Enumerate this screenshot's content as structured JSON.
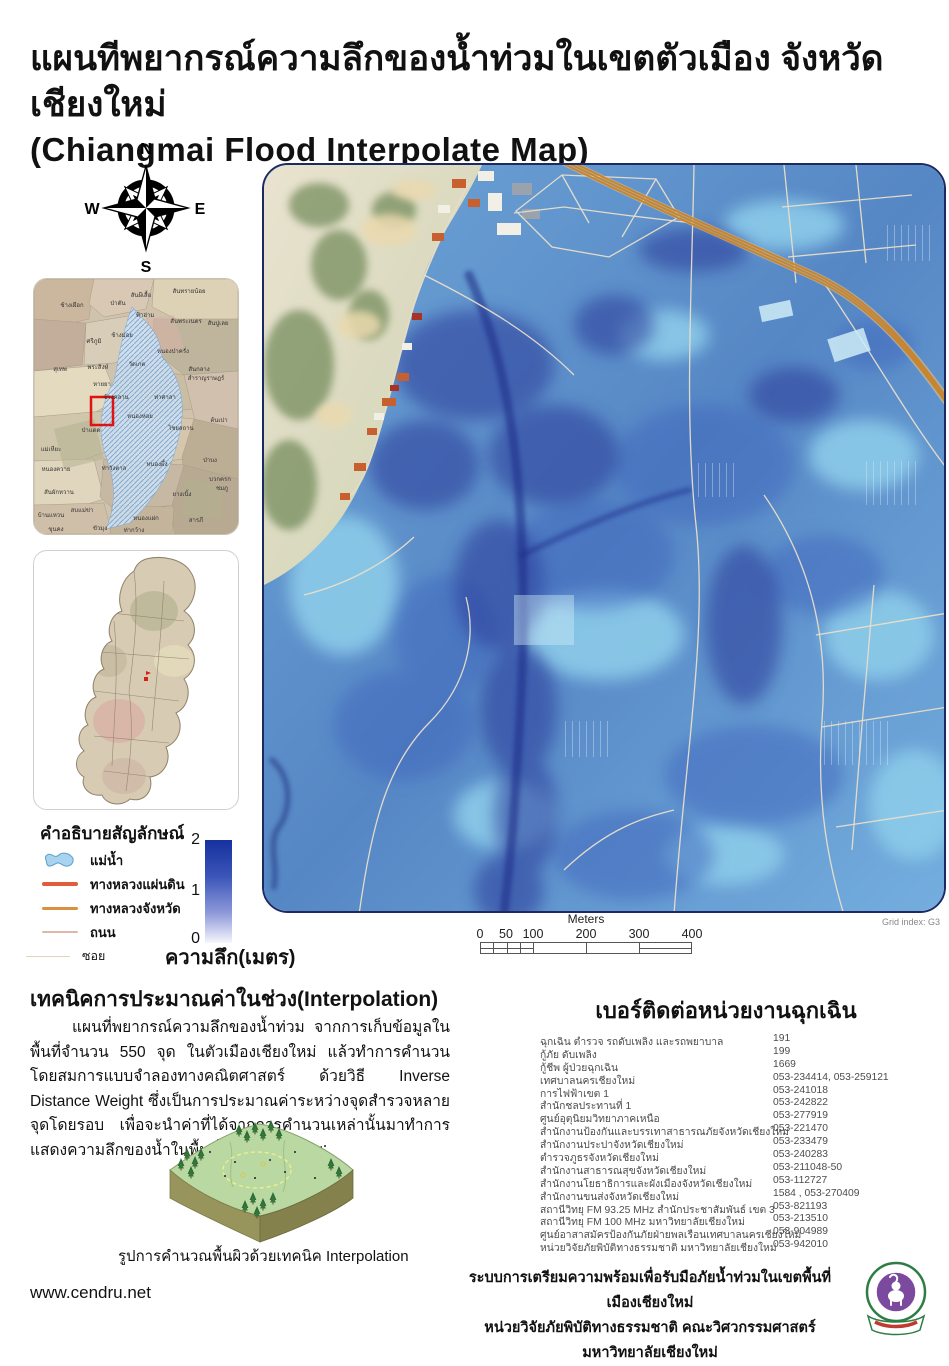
{
  "title": {
    "line1": "แผนทีพยากรณ์ความลึกของน้ำท่วมในเขตตัวเมือง จังหวัดเชียงใหม่",
    "line2": "(Chiangmai Flood Interpolate Map)"
  },
  "compass": {
    "n": "N",
    "e": "E",
    "s": "S",
    "w": "W"
  },
  "locator_map": {
    "marker_color": "#e01212",
    "labels": [
      "สันผีเสื้อ",
      "สันทรายน้อย",
      "ช้างเผือก",
      "ป่าตัน",
      "ฟ้าฮ่าม",
      "สันพระเนตร",
      "สันปูเลย",
      "ช้างม่อย",
      "ศรีภูมิ",
      "หนองป่าครั่ง",
      "สุเทพ",
      "พระสิงห์",
      "วัดเกต",
      "สันกลาง",
      "สำราญราษฎร์",
      "หายยา",
      "ช้างคลาน",
      "ท่าศาลา",
      "หนองหอย",
      "ไชยสถาน",
      "ต้นเปา",
      "ป่าแดด",
      "แม่เหียะ",
      "หนองควาย",
      "ท่าวังตาล",
      "หนองผึ้ง",
      "ป่าบง",
      "ยางเนิ้ง",
      "สันผักหวาน",
      "สบแม่ข่า",
      "บ้านแหวน",
      "หนองแฝก",
      "สารภี",
      "ชมภู",
      "บวกครก",
      "ขุนคง",
      "ขัวมุง",
      "ท่ากว้าง"
    ]
  },
  "legend": {
    "title": "คำอธิบายสัญลักษณ์",
    "items": [
      {
        "label": "แม่น้ำ",
        "icon": "river-polygon"
      },
      {
        "label": "ทางหลวงแผ่นดิน",
        "icon": "thick-red-line"
      },
      {
        "label": "ทางหลวงจังหวัด",
        "icon": "orange-line"
      },
      {
        "label": "ถนน",
        "icon": "thin-pink-line"
      },
      {
        "label": "ซอย",
        "icon": "hairline"
      }
    ]
  },
  "depth_scale": {
    "ticks": [
      "2",
      "1",
      "0"
    ],
    "caption": "ความลึก(เมตร)",
    "top_color": "#16309f",
    "bottom_color": "#f7f7fd"
  },
  "scale_bar": {
    "title": "Meters",
    "ticks": [
      "0",
      "50",
      "100",
      "200",
      "300",
      "400"
    ],
    "grid_index": "Grid index: G3"
  },
  "interpolation": {
    "heading": "เทคนิคการประมาณค่าในช่วง(Interpolation)",
    "paragraph": "แผนที่พยากรณ์ความลึกของน้ำท่วม จากการเก็บข้อมูลในพื้นที่จำนวน 550 จุด ในตัวเมืองเชียงใหม่ แล้วทำการคำนวนโดยสมการแบบจำลองทางคณิตศาสตร์ ด้วยวิธี Inverse Distance Weight ซึ่งเป็นการประมาณค่าระหว่างจุดสำรวจหลายจุดโดยรอบ เพื่อจะนำค่าที่ได้จากการคำนวนเหล่านั้นมาทำการแสดงความลึกของน้ำในพื้นที่เสี่ยงภัย น้ำท่วม",
    "figure_caption": "รูปการคำนวณพื้นผิวด้วยเทคนิค Interpolation"
  },
  "contacts": {
    "heading": "เบอร์ติดต่อหน่วยงานฉุกเฉิน",
    "rows": [
      {
        "name": "ฉุกเฉิน ตำรวจ รถดับเพลิง และรถพยาบาล",
        "phone": "191"
      },
      {
        "name": "กู้ภัย ดับเพลิง",
        "phone": "199"
      },
      {
        "name": "กู้ชีพ ผู้ป่วยฉุกเฉิน",
        "phone": "1669"
      },
      {
        "name": "เทศบาลนครเชียงใหม่",
        "phone": "053-234414, 053-259121"
      },
      {
        "name": "การไฟฟ้าเขต 1",
        "phone": "053-241018"
      },
      {
        "name": "สำนักชลประทานที่ 1",
        "phone": "053-242822"
      },
      {
        "name": "ศูนย์อุตุนิยมวิทยาภาคเหนือ",
        "phone": "053-277919"
      },
      {
        "name": "สำนักงานป้องกันและบรรเทาสาธารณภัยจังหวัดเชียงใหม่",
        "phone": "053-221470"
      },
      {
        "name": "สำนักงานประปาจังหวัดเชียงใหม่",
        "phone": "053-233479"
      },
      {
        "name": "ตำรวจภูธรจังหวัดเชียงใหม่",
        "phone": "053-240283"
      },
      {
        "name": "สำนักงานสาธารณสุขจังหวัดเชียงใหม่",
        "phone": "053-211048-50"
      },
      {
        "name": "สำนักงานโยธาธิการและผังเมืองจังหวัดเชียงใหม่",
        "phone": "053-112727"
      },
      {
        "name": "สำนักงานขนส่งจังหวัดเชียงใหม่",
        "phone": "1584 , 053-270409"
      },
      {
        "name": "สถานีวิทยุ FM 93.25 MHz  สำนักประชาสัมพันธ์ เขต 3",
        "phone": "053-821193"
      },
      {
        "name": "สถานีวิทยุ FM 100 MHz  มหาวิทยาลัยเชียงใหม่",
        "phone": "053-213510"
      },
      {
        "name": "ศูนย์อาสาสมัครป้องกันภัยฝ่ายพลเรือนเทศบาลนครเชียงใหม่",
        "phone": "053-904989"
      },
      {
        "name": "หน่วยวิจัยภัยพิบัติทางธรรมชาติ มหาวิทยาลัยเชียงใหม่",
        "phone": "053-942010"
      }
    ]
  },
  "footer": {
    "website": "www.cendru.net",
    "line1": "ระบบการเตรียมความพร้อมเพื่อรับมือภัยน้ำท่วมในเขตพื้นที่เมืองเชียงใหม่",
    "line2": "หน่วยวิจัยภัยพิบัติทางธรรมชาติ คณะวิศวกรรมศาสตร์ มหาวิทยาลัยเชียงใหม่"
  },
  "colors": {
    "flood_deep": "#2a3a9a",
    "flood_mid": "#3f66bd",
    "flood_light": "#8ccbe9",
    "highway_orange": "#c8852f",
    "road_cream": "#eadfca",
    "legend_national_hwy": "#e05c3a",
    "legend_provincial_hwy": "#d9913f",
    "legend_road": "#e0b8a8",
    "legend_soi": "#e6d8c0",
    "river_fill": "#a8d4f0"
  }
}
